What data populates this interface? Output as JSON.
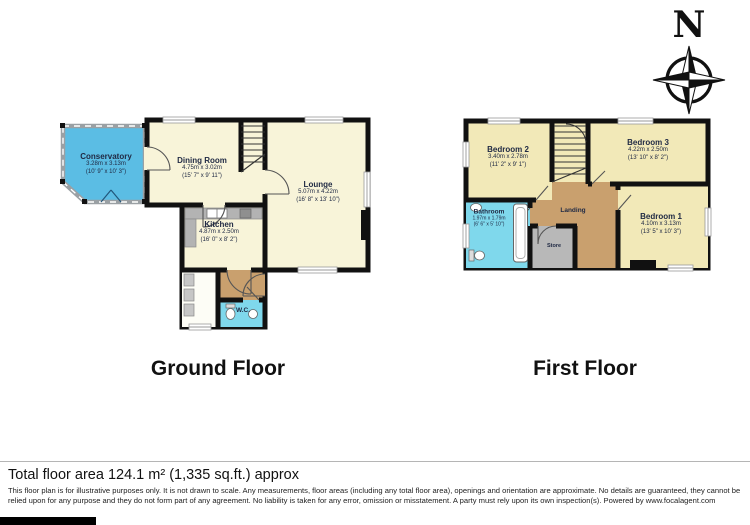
{
  "compass": {
    "letter": "N"
  },
  "ground": {
    "title": "Ground Floor",
    "rooms": [
      {
        "name": "Conservatory",
        "dim_m": "3.28m x 3.13m",
        "dim_ft": "(10' 9\" x 10' 3\")"
      },
      {
        "name": "Dining Room",
        "dim_m": "4.75m x 3.02m",
        "dim_ft": "(15' 7\" x 9' 11\")"
      },
      {
        "name": "Lounge",
        "dim_m": "5.07m x 4.22m",
        "dim_ft": "(16' 8\" x 13' 10\")"
      },
      {
        "name": "Kitchen",
        "dim_m": "4.87m x 2.50m",
        "dim_ft": "(16' 0\" x 8' 2\")"
      },
      {
        "name": "W.C."
      }
    ]
  },
  "first": {
    "title": "First Floor",
    "rooms": [
      {
        "name": "Bedroom 2",
        "dim_m": "3.40m x 2.78m",
        "dim_ft": "(11' 2\" x 9' 1\")"
      },
      {
        "name": "Bedroom 3",
        "dim_m": "4.22m x 2.50m",
        "dim_ft": "(13' 10\" x 8' 2\")"
      },
      {
        "name": "Bedroom 1",
        "dim_m": "4.10m x 3.13m",
        "dim_ft": "(13' 5\" x 10' 3\")"
      },
      {
        "name": "Landing"
      },
      {
        "name": "Bathroom",
        "dim_m": "1.97m x 1.79m",
        "dim_ft": "(6' 6\" x 5' 10\")"
      },
      {
        "name": "Store"
      }
    ]
  },
  "footer": {
    "total_area": "Total floor area 124.1 m² (1,335 sq.ft.) approx",
    "disclaimer": "This floor plan is for illustrative purposes only. It is not drawn to scale. Any measurements, floor areas (including any total floor area), openings and orientation are approximate. No details are guaranteed, they cannot be relied upon for any purpose and they do not form part of any agreement. No liability is taken for any error, omission or misstatement. A party must rely upon its own inspection(s). Powered by www.focalagent.com"
  },
  "colors": {
    "wall": "#111111",
    "room_cream": "#f8f4d9",
    "bedroom_cream": "#f2e9b8",
    "conservatory_blue": "#5bbde4",
    "bath_cyan": "#7fd8ec",
    "hall_tan": "#c9a06e",
    "store_gray": "#b8b8b8"
  }
}
